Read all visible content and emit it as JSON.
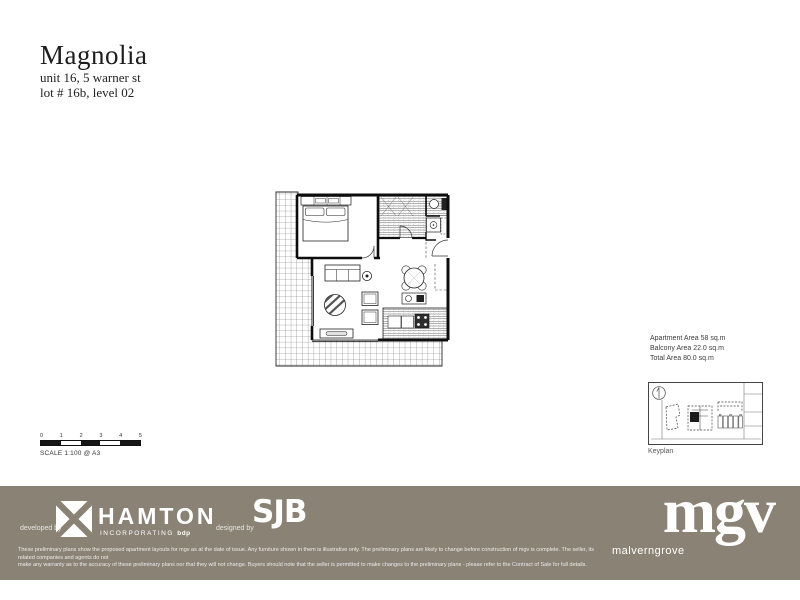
{
  "title_block": {
    "title": "Magnolia",
    "address": "unit 16, 5 warner st",
    "lot": "lot # 16b, level 02"
  },
  "areas": {
    "apartment": "Apartment Area 58 sq.m",
    "balcony": "Balcony Area 22.0 sq.m",
    "total": "Total Area 80.0 sq.m"
  },
  "keyplan": {
    "label": "Keyplan"
  },
  "scale": {
    "ticks": [
      "0",
      "1",
      "2",
      "3",
      "4",
      "5"
    ],
    "label": "SCALE 1:100 @ A3"
  },
  "footer": {
    "background": "#8a8274",
    "developed_by": "developed by",
    "hamton": "HAMTON",
    "incorporating": "INCORPORATING",
    "bdp": "bdp",
    "designed_by": "designed by",
    "sjb": "SJB",
    "mgv": "mgv",
    "malverngrove": "malverngrove",
    "disclaimer_line1": "These preliminary plans show the proposed apartment layouts for mgv as at the date of issue. Any furniture shown in them is illustrative only. The preliminary plans are likely to change before construction of mgv is complete. The seller, its related companies and agents do not",
    "disclaimer_line2": "make any warranty as to the accuracy of these preliminary plans nor that they will not change. Buyers should note that the seller is permitted to make changes to the preliminary plans - please refer to the Contract of Sale for full details."
  }
}
